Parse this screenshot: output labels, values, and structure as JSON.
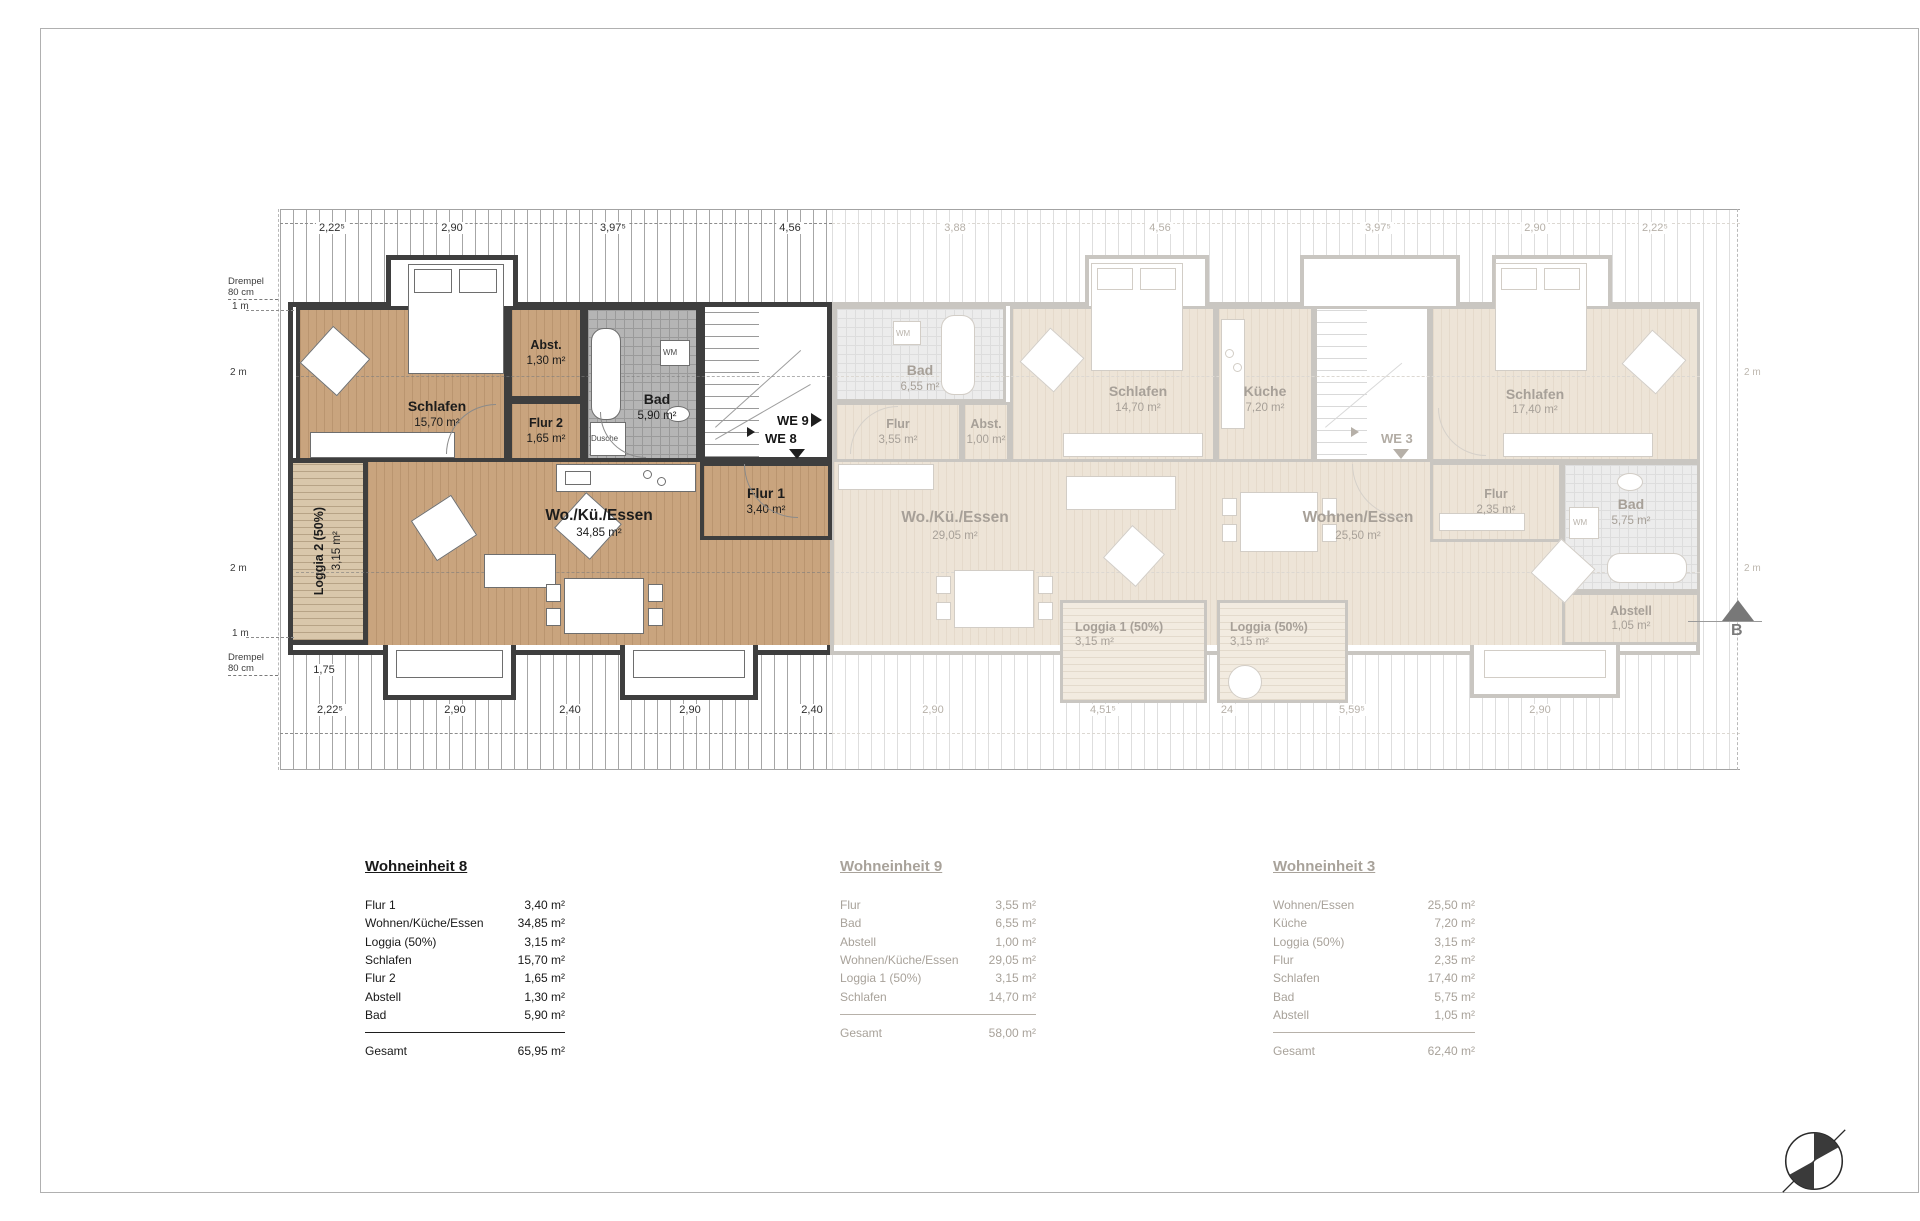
{
  "palette": {
    "wall_dark": "#3e3e3e",
    "wall_faded": "#c9c6c1",
    "floor_wood": "#c9a47e",
    "floor_pale": "#ede4d7",
    "tile_dark": "#b5b5b5",
    "tile_pale": "#ececec",
    "text_dark": "#1c1c1c",
    "text_faded": "#a7a098",
    "marker_gray": "#787878"
  },
  "dims": {
    "top": [
      "2,22⁵",
      "2,90",
      "3,97⁵",
      "4,56",
      "3,88",
      "4,56",
      "3,97⁵",
      "2,90",
      "2,22⁵"
    ],
    "bottom": [
      "2,22⁵",
      "2,90",
      "2,40",
      "2,90",
      "2,40",
      "2,90",
      "4,51⁵",
      "24",
      "5,59⁵",
      "2,90"
    ],
    "inner": "1,75"
  },
  "heights": {
    "drempel_line1": "Drempel",
    "drempel_line2": "80 cm",
    "one_m": "1 m",
    "two_m": "2 m"
  },
  "units": {
    "we8": {
      "schlafen_name": "Schlafen",
      "schlafen_area": "15,70 m²",
      "abst_name": "Abst.",
      "abst_area": "1,30 m²",
      "bad_name": "Bad",
      "bad_area": "5,90 m²",
      "flur2_name": "Flur 2",
      "flur2_area": "1,65 m²",
      "flur1_name": "Flur 1",
      "flur1_area": "3,40 m²",
      "wohnen_name": "Wo./Kü./Essen",
      "wohnen_area": "34,85 m²",
      "loggia_name": "Loggia 2 (50%)",
      "loggia_area": "3,15 m²",
      "dusche": "Dusche",
      "wm": "WM"
    },
    "we9": {
      "bad_name": "Bad",
      "bad_area": "6,55 m²",
      "flur_name": "Flur",
      "flur_area": "3,55 m²",
      "abst_name": "Abst.",
      "abst_area": "1,00 m²",
      "schlafen_name": "Schlafen",
      "schlafen_area": "14,70 m²",
      "wohnen_name": "Wo./Kü./Essen",
      "wohnen_area": "29,05 m²",
      "loggia_name": "Loggia 1 (50%)",
      "loggia_area": "3,15 m²",
      "wm": "WM"
    },
    "we3": {
      "kueche_name": "Küche",
      "kueche_area": "7,20 m²",
      "schlafen_name": "Schlafen",
      "schlafen_area": "17,40 m²",
      "flur_name": "Flur",
      "flur_area": "2,35 m²",
      "bad_name": "Bad",
      "bad_area": "5,75 m²",
      "abstell_name": "Abstell",
      "abstell_area": "1,05 m²",
      "wohnen_name": "Wohnen/Essen",
      "wohnen_area": "25,50 m²",
      "loggia_name": "Loggia (50%)",
      "loggia_area": "3,15 m²",
      "wm": "WM"
    }
  },
  "markers": {
    "we9": "WE 9",
    "we8": "WE 8",
    "we3": "WE 3",
    "section": "B"
  },
  "tables": {
    "we8": {
      "title": "Wohneinheit 8",
      "rows": [
        [
          "Flur 1",
          "3,40 m²"
        ],
        [
          "Wohnen/Küche/Essen",
          "34,85 m²"
        ],
        [
          "Loggia (50%)",
          "3,15 m²"
        ],
        [
          "Schlafen",
          "15,70 m²"
        ],
        [
          "Flur 2",
          "1,65 m²"
        ],
        [
          "Abstell",
          "1,30 m²"
        ],
        [
          "Bad",
          "5,90 m²"
        ]
      ],
      "total_label": "Gesamt",
      "total_value": "65,95 m²"
    },
    "we9": {
      "title": "Wohneinheit 9",
      "rows": [
        [
          "Flur",
          "3,55 m²"
        ],
        [
          "Bad",
          "6,55 m²"
        ],
        [
          "Abstell",
          "1,00 m²"
        ],
        [
          "Wohnen/Küche/Essen",
          "29,05 m²"
        ],
        [
          "Loggia 1 (50%)",
          "3,15 m²"
        ],
        [
          "Schlafen",
          "14,70 m²"
        ]
      ],
      "total_label": "Gesamt",
      "total_value": "58,00 m²"
    },
    "we3": {
      "title": "Wohneinheit 3",
      "rows": [
        [
          "Wohnen/Essen",
          "25,50 m²"
        ],
        [
          "Küche",
          "7,20 m²"
        ],
        [
          "Loggia (50%)",
          "3,15 m²"
        ],
        [
          "Flur",
          "2,35 m²"
        ],
        [
          "Schlafen",
          "17,40 m²"
        ],
        [
          "Bad",
          "5,75 m²"
        ],
        [
          "Abstell",
          "1,05 m²"
        ]
      ],
      "total_label": "Gesamt",
      "total_value": "62,40 m²"
    }
  }
}
